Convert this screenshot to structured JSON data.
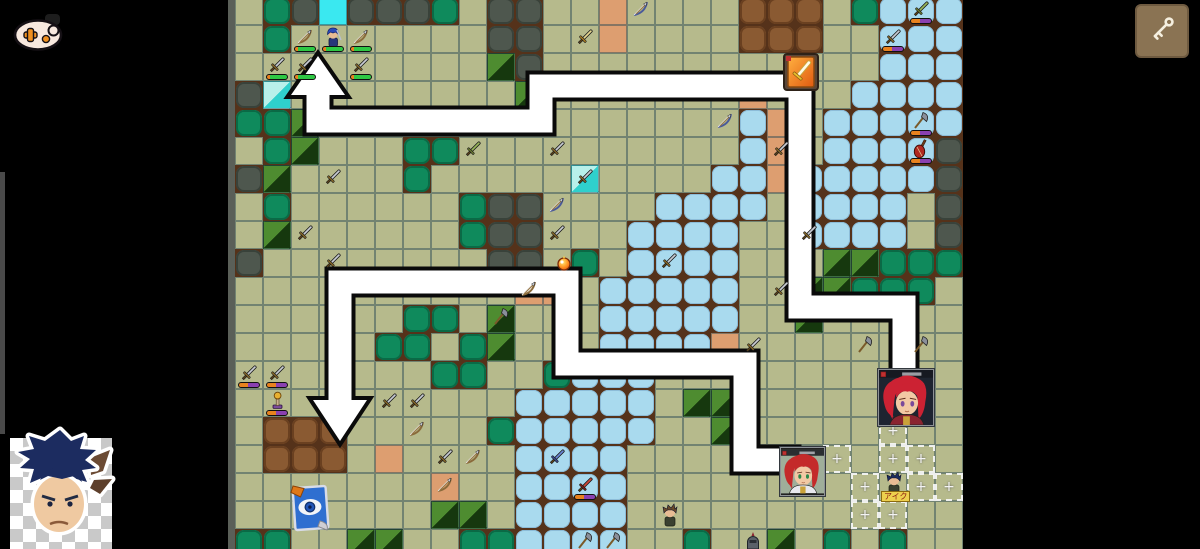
{
  "hud": {
    "controller_button": {
      "icon": "game-controller-icon"
    },
    "tool_button": {
      "icon": "key-icon",
      "bg": "#8a7353"
    },
    "avatar": {
      "icon": "blue-haired-avatar-sticker",
      "backdrop": "transparency-checkerboard"
    }
  },
  "map": {
    "origin_x": 235,
    "origin_y": -3,
    "tile_size": 28,
    "cols": 26,
    "rows": 20,
    "legend": {
      ".": "grass",
      "D": "dark-bush",
      "B": "green-bush",
      "F": "forest",
      "W": "water",
      "M": "dirt-mound",
      "S": "sand",
      "C": "cyan-marker",
      "T": "cyan-forest"
    },
    "grid": [
      ".BDCDDDB.DD..S....MMM.BWWW",
      ".B.......DD..S....MMM..WWW",
      ".........FD............WWW",
      "DT........F.......S...WWWW",
      "BBF...............WS.WWWWW",
      ".BF...BB..........WS.WWWWD",
      "DF....B.....T....WWSWWWWWD",
      ".B......BDD....WWWW.WWWW.D",
      ".F......BDD...WWWW..WWWW.D",
      "D........DD.B.WWWW...FFBBB",
      "..........SS.WWWWW..FFBBB.",
      "......BB.F...WWWWW..F.....",
      ".....BB.BF...WWWWS........",
      ".......BB..BWWW...........",
      "..........WWWWW.FF........",
      ".MMM.....BWWWWW..F........",
      ".MMM.S....WWWW............",
      ".......S..WWWW............",
      ".......FF.WWWW............",
      "BB..FF..BBWWWW..B..F.B.B.."
    ],
    "movement_paths": [
      {
        "name": "path-north",
        "direction": "up",
        "points": [
          [
            904,
            372
          ],
          [
            904,
            307
          ],
          [
            800,
            307
          ],
          [
            800,
            86
          ],
          [
            541,
            86
          ],
          [
            541,
            121
          ],
          [
            318,
            121
          ],
          [
            318,
            94
          ]
        ],
        "arrowhead": [
          [
            318,
            56
          ],
          [
            291,
            95
          ],
          [
            345,
            95
          ]
        ]
      },
      {
        "name": "path-southwest",
        "direction": "down",
        "points": [
          [
            786,
            460
          ],
          [
            745,
            460
          ],
          [
            745,
            364
          ],
          [
            567,
            364
          ],
          [
            567,
            282
          ],
          [
            340,
            282
          ],
          [
            340,
            399
          ]
        ],
        "arrowhead": [
          [
            340,
            441
          ],
          [
            313,
            400
          ],
          [
            367,
            400
          ]
        ]
      }
    ],
    "player_units": [
      {
        "type": "bow",
        "col": 2,
        "row": 1
      },
      {
        "type": "hero",
        "col": 3,
        "row": 1
      },
      {
        "type": "bow",
        "col": 4,
        "row": 1
      },
      {
        "type": "sword",
        "col": 1,
        "row": 2
      },
      {
        "type": "sword",
        "col": 2,
        "row": 2
      },
      {
        "type": "sword",
        "col": 4,
        "row": 2
      }
    ],
    "enemy_units": [
      {
        "type": "sword",
        "col": 0,
        "row": 13
      },
      {
        "type": "sword",
        "col": 1,
        "row": 13
      },
      {
        "type": "lamp",
        "col": 1,
        "row": 14
      },
      {
        "type": "sword_green",
        "col": 24,
        "row": 0
      },
      {
        "type": "sword",
        "col": 23,
        "row": 1
      },
      {
        "type": "axe",
        "col": 24,
        "row": 4
      },
      {
        "type": "violin",
        "col": 24,
        "row": 5
      },
      {
        "type": "sword_red",
        "col": 12,
        "row": 17
      },
      {
        "type": "axe",
        "col": 12,
        "row": 19
      },
      {
        "type": "axe",
        "col": 13,
        "row": 19
      },
      {
        "type": "knight",
        "col": 18,
        "row": 19
      }
    ],
    "loose_weapons": [
      {
        "type": "sword_gold",
        "col": 12,
        "row": 1
      },
      {
        "type": "bow_blue",
        "col": 14,
        "row": 0
      },
      {
        "type": "sword",
        "col": 3,
        "row": 6
      },
      {
        "type": "sword",
        "col": 2,
        "row": 8
      },
      {
        "type": "sword",
        "col": 3,
        "row": 9
      },
      {
        "type": "sword_green",
        "col": 8,
        "row": 5
      },
      {
        "type": "sword",
        "col": 11,
        "row": 5
      },
      {
        "type": "sword",
        "col": 12,
        "row": 6
      },
      {
        "type": "bow_blue",
        "col": 11,
        "row": 7
      },
      {
        "type": "sword",
        "col": 11,
        "row": 8
      },
      {
        "type": "bow_blue",
        "col": 17,
        "row": 4
      },
      {
        "type": "sword",
        "col": 19,
        "row": 5
      },
      {
        "type": "sword",
        "col": 15,
        "row": 9
      },
      {
        "type": "sword",
        "col": 20,
        "row": 8
      },
      {
        "type": "sword",
        "col": 19,
        "row": 10
      },
      {
        "type": "sword",
        "col": 18,
        "row": 12
      },
      {
        "type": "axe",
        "col": 22,
        "row": 12
      },
      {
        "type": "axe",
        "col": 24,
        "row": 12
      },
      {
        "type": "bow",
        "col": 10,
        "row": 10
      },
      {
        "type": "axe",
        "col": 9,
        "row": 11
      },
      {
        "type": "sword",
        "col": 5,
        "row": 14
      },
      {
        "type": "sword",
        "col": 6,
        "row": 14
      },
      {
        "type": "bow",
        "col": 6,
        "row": 15
      },
      {
        "type": "sword",
        "col": 7,
        "row": 16
      },
      {
        "type": "bow",
        "col": 8,
        "row": 16
      },
      {
        "type": "bow",
        "col": 7,
        "row": 17
      },
      {
        "type": "sword_blue",
        "col": 11,
        "row": 16
      }
    ],
    "range_tiles": [
      [
        23,
        15
      ],
      [
        21,
        16
      ],
      [
        23,
        16
      ],
      [
        24,
        16
      ],
      [
        22,
        17
      ],
      [
        24,
        17
      ],
      [
        25,
        17
      ],
      [
        22,
        18
      ],
      [
        23,
        18
      ]
    ],
    "range_marker": "+",
    "portraits": [
      {
        "name": "portrait-red-girl-dark",
        "x": 878,
        "y": 369,
        "w": 56,
        "h": 57,
        "bg": "#1e2430",
        "hair": "#cc2233",
        "eyes": "#7a4a9a",
        "outfit": "#8a2430",
        "accent": "#caa23a"
      },
      {
        "name": "portrait-red-girl-light",
        "x": 780,
        "y": 447,
        "w": 45,
        "h": 49,
        "bg": "#9fae9a",
        "hair": "#c42a2a",
        "eyes": "#2a8a4a",
        "outfit": "#e8e8ee",
        "accent": "#caa23a"
      }
    ],
    "items": [
      {
        "type": "shield-badge",
        "x": 782,
        "y": 52
      },
      {
        "type": "fire-orb",
        "x": 556,
        "y": 255
      },
      {
        "type": "eye-card",
        "x": 288,
        "y": 483
      }
    ],
    "tagged_sprite": {
      "label": "アイク",
      "col": 23,
      "row": 17
    },
    "extra_sprites": [
      {
        "type": "villager",
        "col": 15,
        "row": 18
      }
    ]
  },
  "palette": {
    "grass": "#b6ba8c",
    "grid_line": "#4e6068",
    "dirt_bg": "#55321a",
    "water": "#a9daee",
    "dark_bush": "#4e574e",
    "green_bush": "#0f8a5c",
    "forest_light": "#4e8c30",
    "forest_dark": "#16380e",
    "dirt_mound": "#8a5a32",
    "sand": "#dd9e70",
    "cyan": "#3ae8f0",
    "path_white": "#ffffff",
    "path_black": "#0a0a0a",
    "hp_green": "#2ec844",
    "hp_purple": "#8a40b0",
    "hp_orange": "#e8821e"
  }
}
